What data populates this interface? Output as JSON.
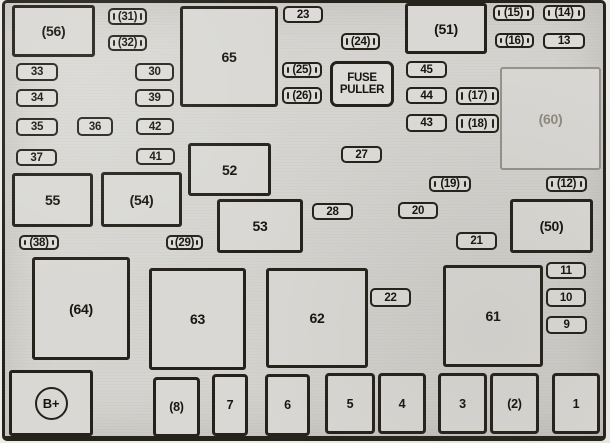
{
  "colors": {
    "background": "#d6d5d1",
    "line": "#25221c",
    "faded_line": "#95928a",
    "text": "#17150f"
  },
  "relays": {
    "r56": "(56)",
    "r65": "65",
    "r51": "(51)",
    "r60": "(60)",
    "r52": "52",
    "r55": "55",
    "r54": "(54)",
    "r53": "53",
    "r50": "(50)",
    "r64": "(64)",
    "r63": "63",
    "r62": "62",
    "r61": "61"
  },
  "fuses": {
    "f31": "(31)",
    "f32": "(32)",
    "f33": "33",
    "f34": "34",
    "f35": "35",
    "f36": "36",
    "f37": "37",
    "f30": "30",
    "f39": "39",
    "f42": "42",
    "f41": "41",
    "f23": "23",
    "f24": "(24)",
    "f25": "(25)",
    "f26": "(26)",
    "f45": "45",
    "f44": "44",
    "f43": "43",
    "f17": "(17)",
    "f18": "(18)",
    "f15": "(15)",
    "f14": "(14)",
    "f16": "(16)",
    "f13": "13",
    "f27": "27",
    "f19": "(19)",
    "f12": "(12)",
    "f28": "28",
    "f20": "20",
    "f21": "21",
    "f38": "(38)",
    "f29": "(29)",
    "f22": "22",
    "f11": "11",
    "f10": "10",
    "f9": "9"
  },
  "tools": {
    "fuse_puller_line1": "FUSE",
    "fuse_puller_line2": "PULLER"
  },
  "battery": {
    "label": "B+"
  },
  "slots": {
    "s8": "(8)",
    "s7": "7",
    "s6": "6",
    "s5": "5",
    "s4": "4",
    "s3": "3",
    "s2": "(2)",
    "s1": "1"
  }
}
